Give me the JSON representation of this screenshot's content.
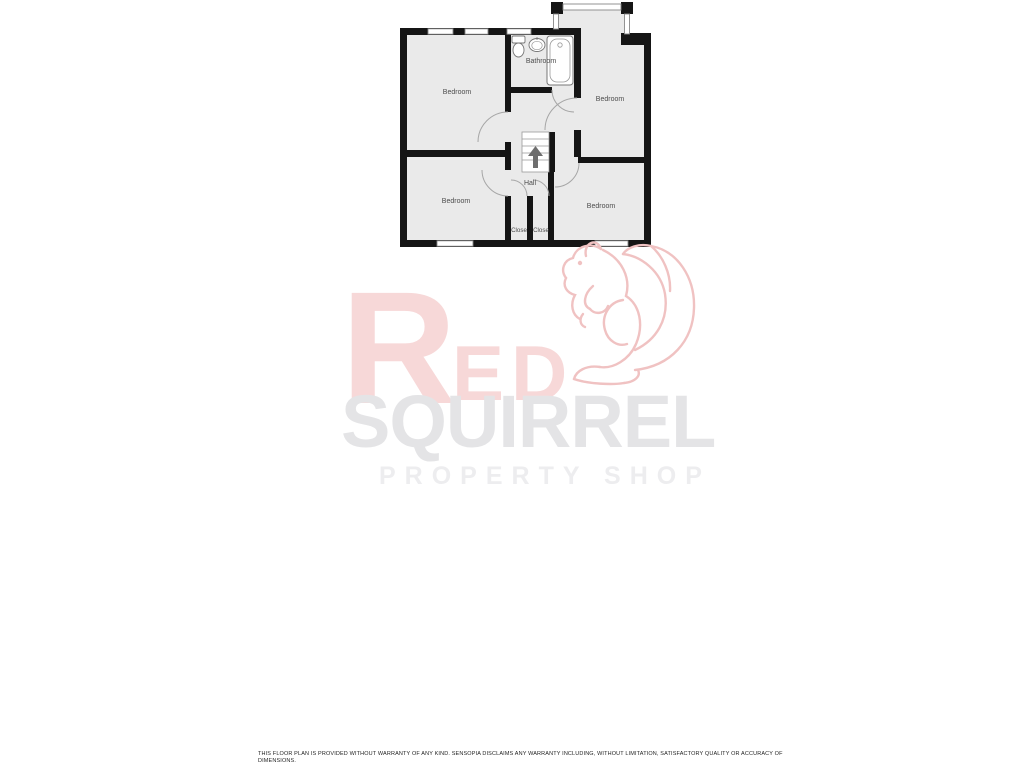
{
  "floorplan": {
    "labels": {
      "bedroom_top_left": "Bedroom",
      "bedroom_top_right": "Bedroom",
      "bedroom_bottom_left": "Bedroom",
      "bedroom_bottom_right": "Bedroom",
      "bathroom": "Bathroom",
      "hall": "Hall",
      "closet_left": "Close",
      "closet_right": "Close"
    },
    "colors": {
      "wall": "#151515",
      "floor": "#eaeaea",
      "label_text": "#4d4d4d",
      "door_arc": "#a6a6a6",
      "stairs_arrow": "#6e6e6e"
    }
  },
  "watermark": {
    "word_initial": "R",
    "word_rest": "ED",
    "line2": "SQUIRREL",
    "line3": "PROPERTY SHOP",
    "brand_red_faded": "#f7d8d8",
    "squirrel_outline": "#f0c2c2",
    "gray_text": "#e4e4e6"
  },
  "disclaimer": {
    "line1": "THIS FLOOR PLAN IS PROVIDED WITHOUT WARRANTY OF ANY KIND. SENSOPIA DISCLAIMS ANY WARRANTY INCLUDING, WITHOUT LIMITATION, SATISFACTORY QUALITY OR ACCURACY OF",
    "line2": "DIMENSIONS."
  }
}
